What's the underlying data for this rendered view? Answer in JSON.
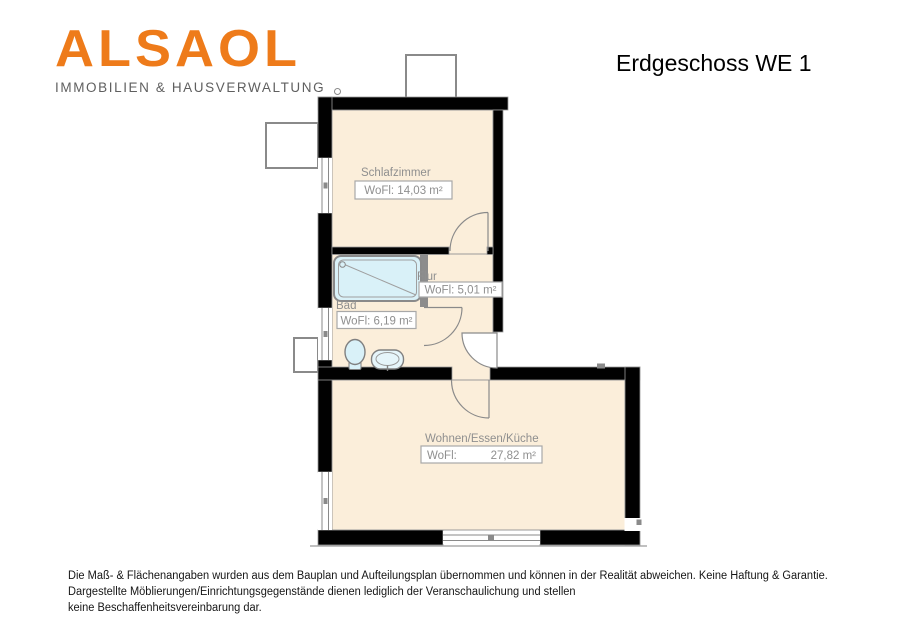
{
  "header": {
    "logo_text": "ALSAOL",
    "logo_tagline": "IMMOBILIEN & HAUSVERWALTUNG",
    "plan_title": "Erdgeschoss WE 1"
  },
  "floorplan": {
    "rooms": [
      {
        "name": "Schlafzimmer",
        "area": "WoFl: 14,03 m²"
      },
      {
        "name": "Flur",
        "area": "WoFl: 5,01 m²"
      },
      {
        "name": "Bad",
        "area": "WoFl: 6,19 m²"
      },
      {
        "name": "Wohnen/Essen/Küche",
        "area_prefix": "WoFl:",
        "area_value": "27,82 m²"
      }
    ],
    "fixtures": [
      "bathtub",
      "toilet",
      "sink"
    ]
  },
  "footer": {
    "lines": [
      "Die Maß- & Flächenangaben wurden aus dem Bauplan und Aufteilungsplan übernommen und können in der Realität abweichen. Keine Haftung & Garantie.",
      "Dargestellte Möblierungen/Einrichtungsgegenstände dienen lediglich der Veranschaulichung und stellen",
      "keine Beschaffenheitsvereinbarung dar."
    ]
  },
  "colors": {
    "logo_orange": "#ee7b1a",
    "tagline_gray": "#5f5f5f",
    "wall_black": "#010101",
    "interior_wall_gray": "#8c8c8c",
    "floor_cream": "#fbeeda",
    "fixture_blue": "#d9f1f8",
    "label_gray": "#8f8f8f",
    "outline_gray": "#9b9b9b"
  }
}
